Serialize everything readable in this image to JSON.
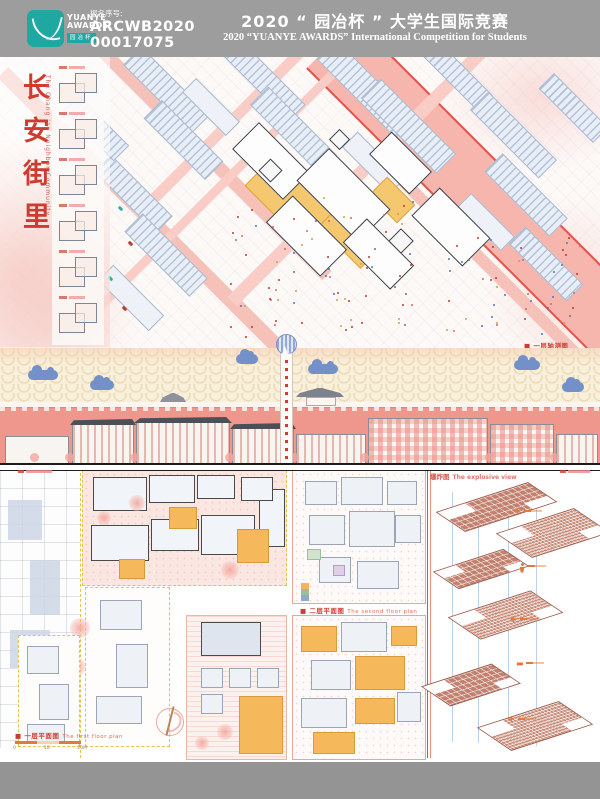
{
  "header": {
    "logo": {
      "line1": "YUANYE",
      "line2": "AWARDS",
      "cn": "园冶杯"
    },
    "registration": {
      "label": "报名序号:",
      "number_line1": "ARCWB2020",
      "number_line2": "00017075"
    },
    "title_cn": "2020 “ 园冶杯 ” 大学生国际竞赛",
    "title_en": "2020 “YUANYE AWARDS” International Competition for  Students"
  },
  "poster": {
    "left_column": {
      "title_cn_vertical": "长安街里",
      "title_en_vertical": "The Chang 'an Neighbor Community"
    },
    "siteplan": {
      "corner_label": "■ 一层轴测图"
    },
    "plans": {
      "first_floor_label_cn": "■ 一层平面图",
      "first_floor_label_en": "The first floor plan",
      "scale_ticks": [
        "0",
        "10",
        "20M"
      ],
      "second_floor_label_cn": "■ 二层平面图",
      "second_floor_label_en": "The second floor plan"
    },
    "explosive": {
      "title_cn": "爆炸图",
      "title_en": "The explosive view"
    }
  },
  "colors": {
    "accent_red": "#cf3b31",
    "salmon_road": "#f7b6ad",
    "wall_red": "#f0978d",
    "logo_teal": "#1fa8a2",
    "courtyard_orange": "#f5c76f",
    "wave_cream": "#f8f0da",
    "cloud_blue": "#7490c8",
    "terracotta": "#c2806f"
  },
  "icons": [
    "yuanye-logo-icon",
    "cloud-icon",
    "hot-air-balloon-icon",
    "gate-roof-icon",
    "north-arrow-icon",
    "person-icon",
    "medical-cross-icon"
  ]
}
